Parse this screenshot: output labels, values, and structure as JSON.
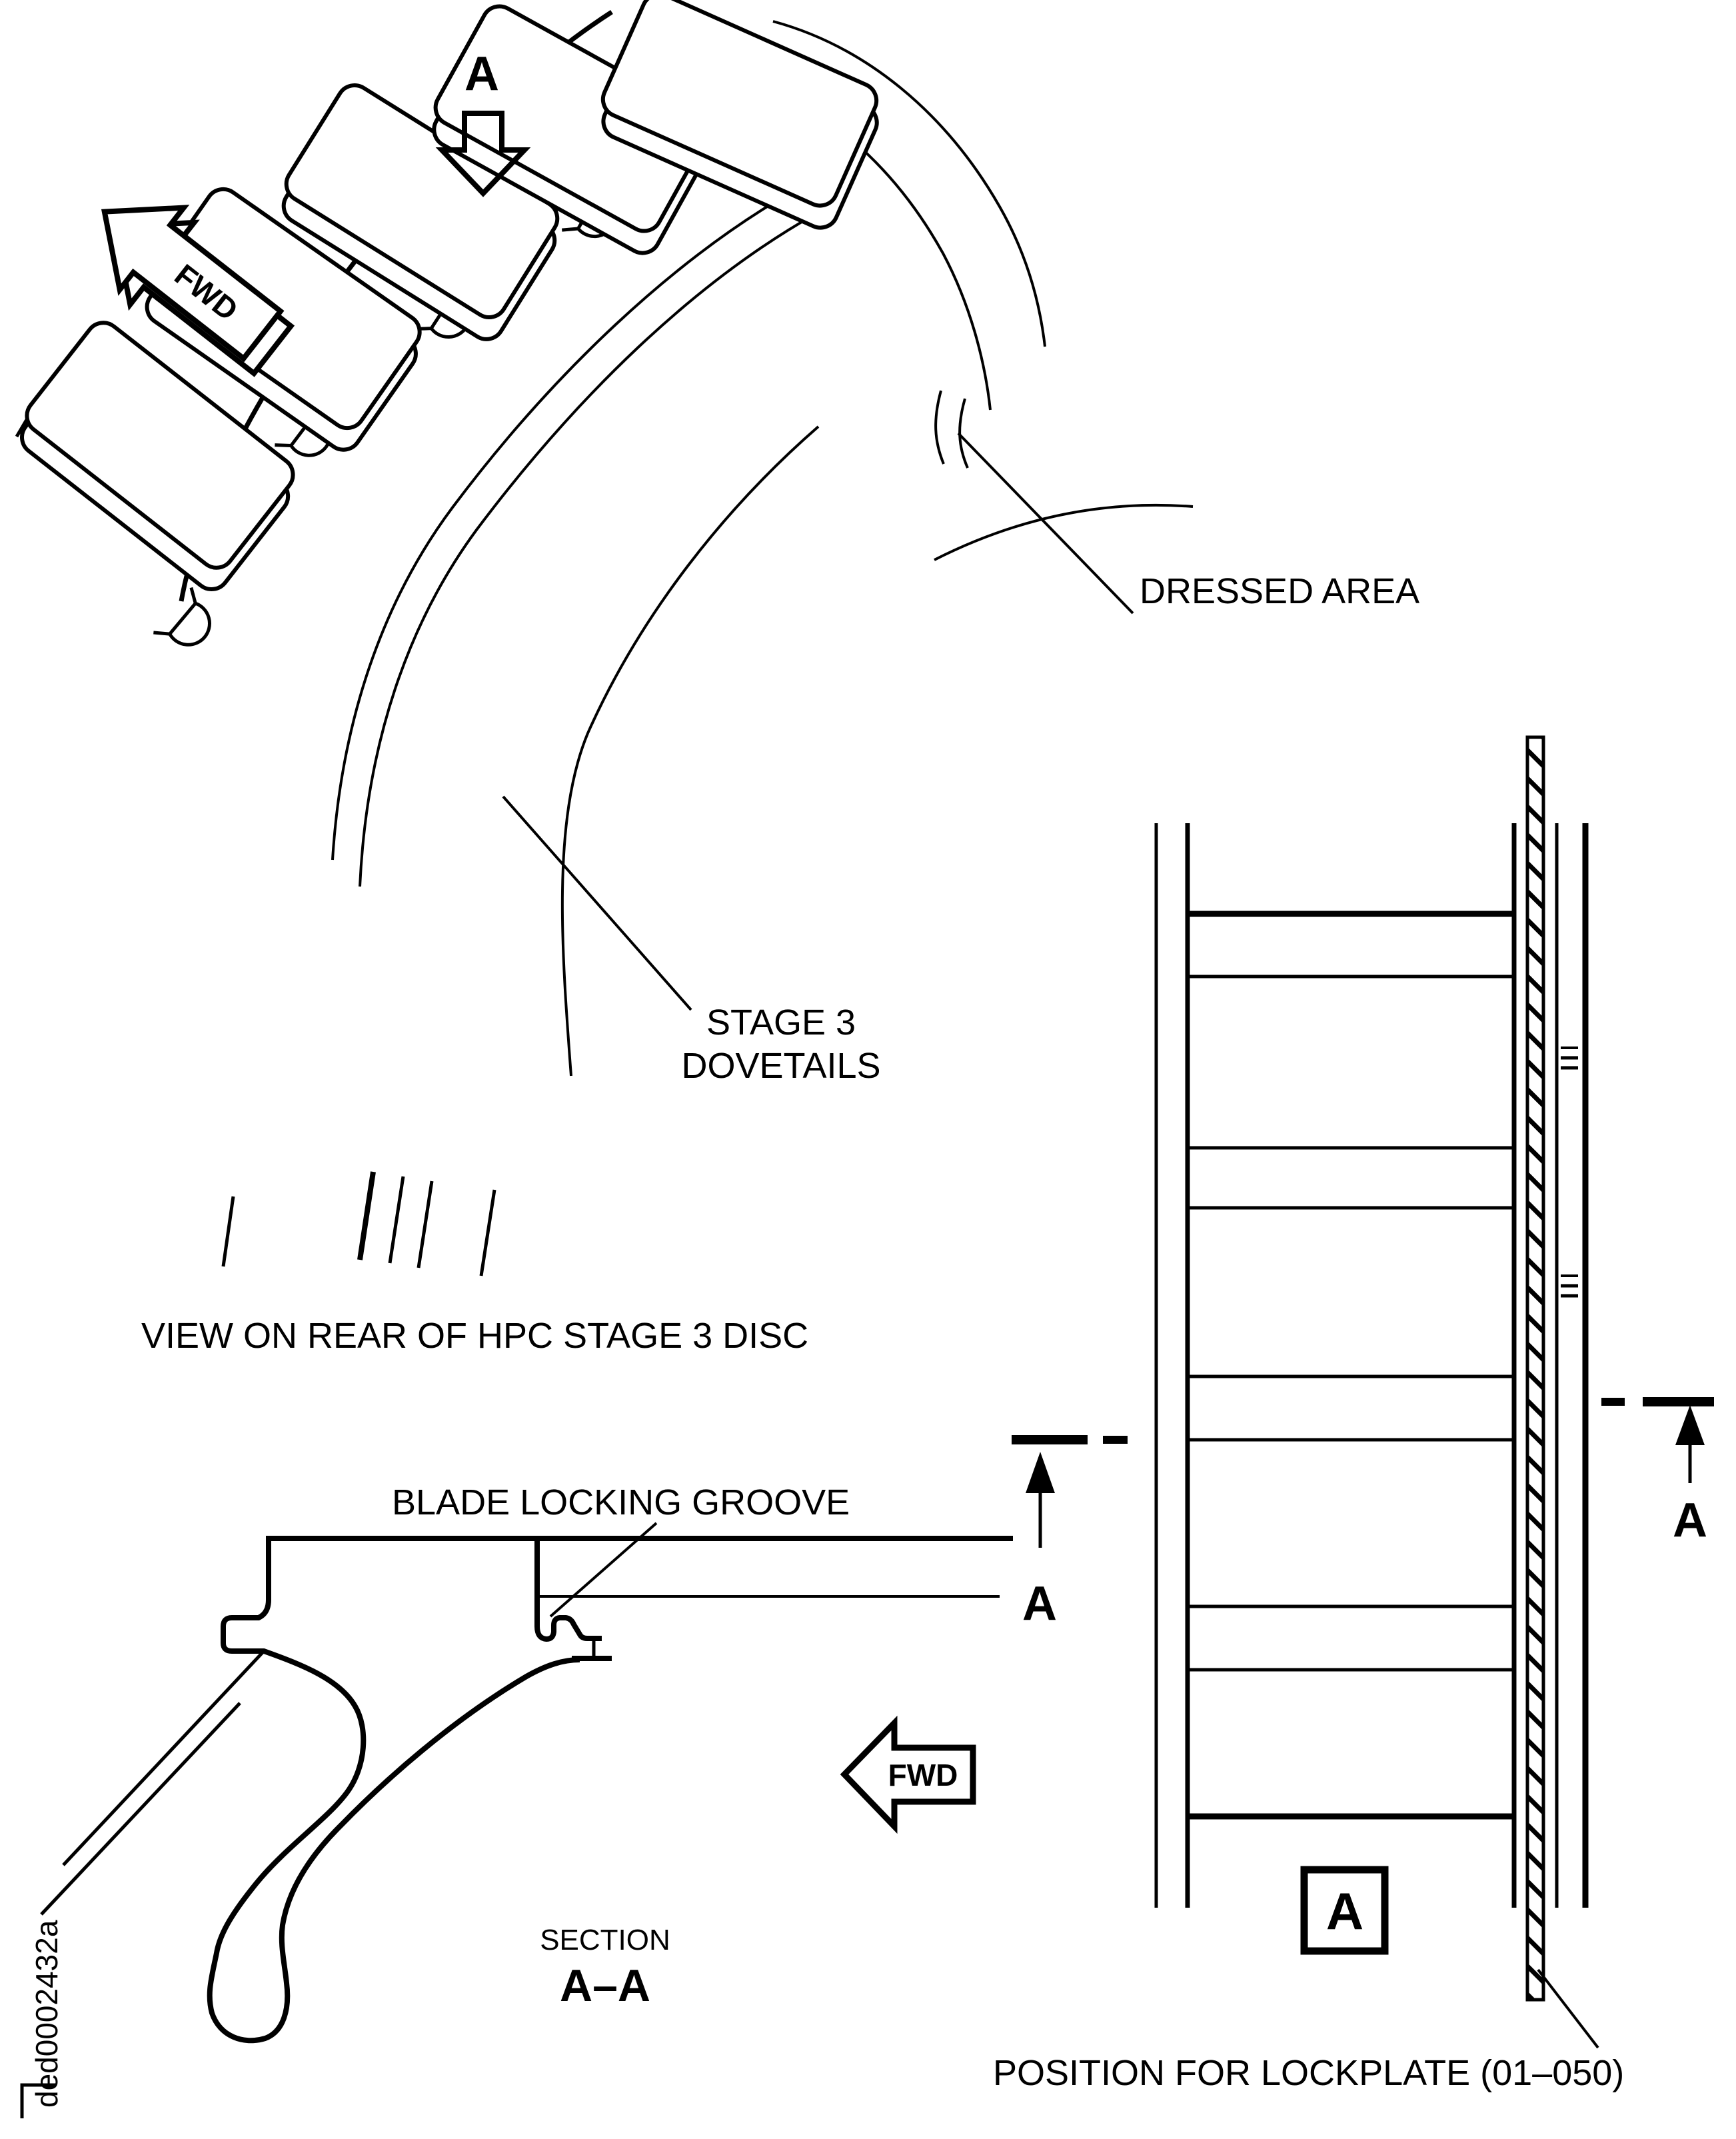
{
  "drawing": {
    "section_marker": "A",
    "fwd_label": "FWD",
    "annotations": {
      "dressed_area": "DRESSED AREA",
      "stage3_line1": "STAGE 3",
      "stage3_line2": "DOVETAILS",
      "view_caption": "VIEW ON REAR OF HPC STAGE 3 DISC",
      "blade_locking_groove": "BLADE LOCKING GROOVE",
      "section_prefix": "SECTION",
      "section_title": "A–A",
      "position_for_lockplate": "POSITION FOR LOCKPLATE (01–050)",
      "detail_marker": "A",
      "doc_id": "ded0002432a"
    },
    "colors": {
      "ink": "#000000",
      "paper": "#ffffff"
    }
  }
}
